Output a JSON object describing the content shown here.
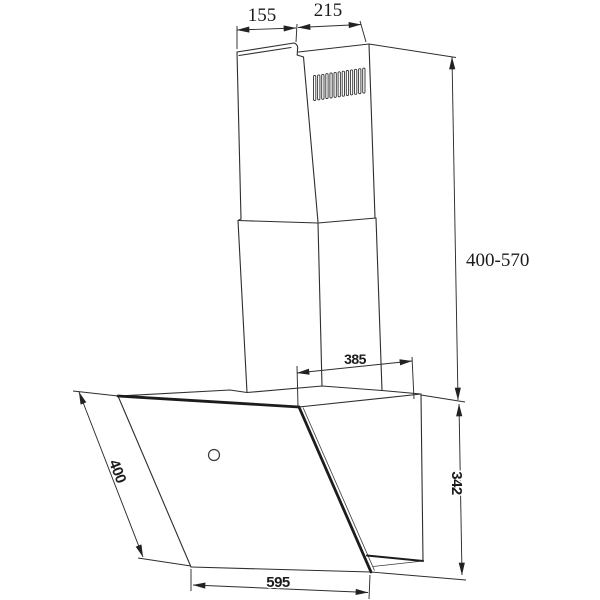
{
  "diagram": {
    "dims": {
      "top_side_depth": "155",
      "top_front_width": "215",
      "chimney_height_range": "400-570",
      "top_mount_depth": "385",
      "panel_diagonal": "400",
      "body_height": "342",
      "body_width": "595"
    }
  }
}
